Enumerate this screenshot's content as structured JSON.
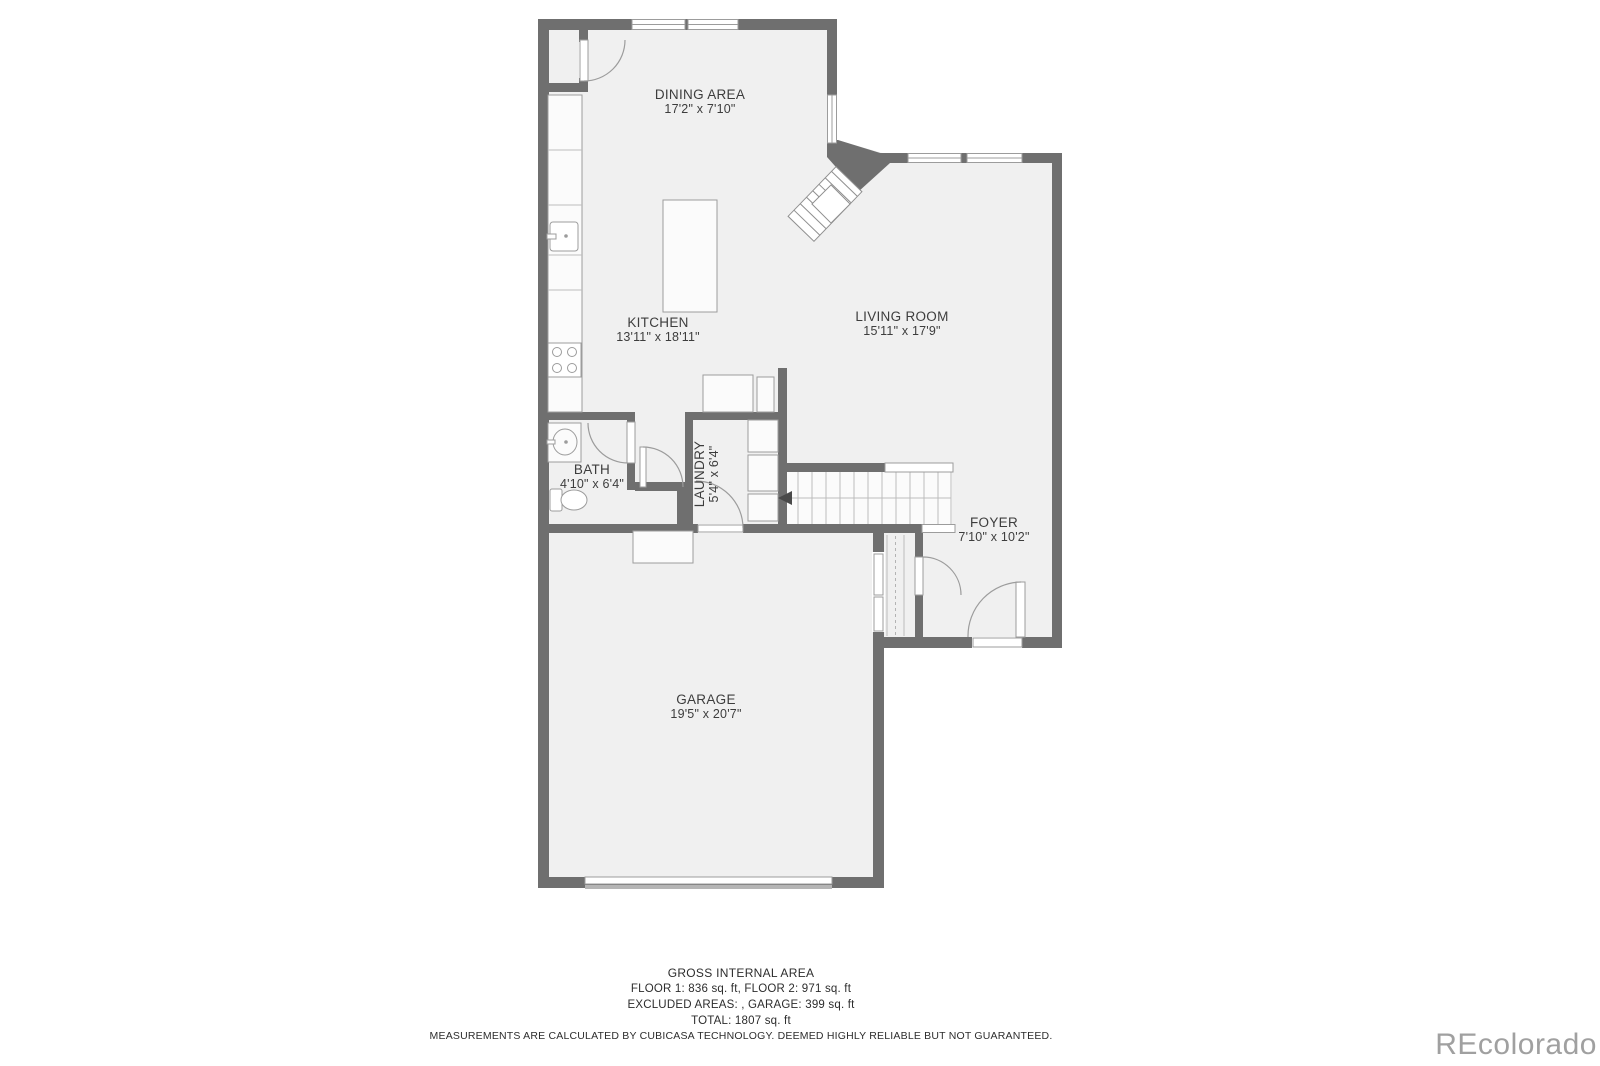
{
  "colors": {
    "wall": "#6f6f6f",
    "floor": "#f0f0f0",
    "line": "#9c9c9c",
    "text": "#3d3d3d"
  },
  "rooms": {
    "dining": {
      "name": "DINING AREA",
      "dims": "17'2\" x 7'10\""
    },
    "kitchen": {
      "name": "KITCHEN",
      "dims": "13'11\" x 18'11\""
    },
    "living": {
      "name": "LIVING ROOM",
      "dims": "15'11\" x 17'9\""
    },
    "bath": {
      "name": "BATH",
      "dims": "4'10\" x 6'4\""
    },
    "laundry": {
      "name": "LAUNDRY",
      "dims": "5'4\" x 6'4\""
    },
    "foyer": {
      "name": "FOYER",
      "dims": "7'10\" x 10'2\""
    },
    "garage": {
      "name": "GARAGE",
      "dims": "19'5\" x 20'7\""
    }
  },
  "footer": {
    "title": "GROSS INTERNAL AREA",
    "line1": "FLOOR 1: 836 sq. ft, FLOOR 2: 971 sq. ft",
    "line2": "EXCLUDED AREAS: , GARAGE: 399 sq. ft",
    "line3": "TOTAL: 1807 sq. ft",
    "disclaimer": "MEASUREMENTS ARE CALCULATED BY CUBICASA TECHNOLOGY. DEEMED HIGHLY RELIABLE BUT NOT GUARANTEED."
  },
  "watermark": "REcolorado"
}
